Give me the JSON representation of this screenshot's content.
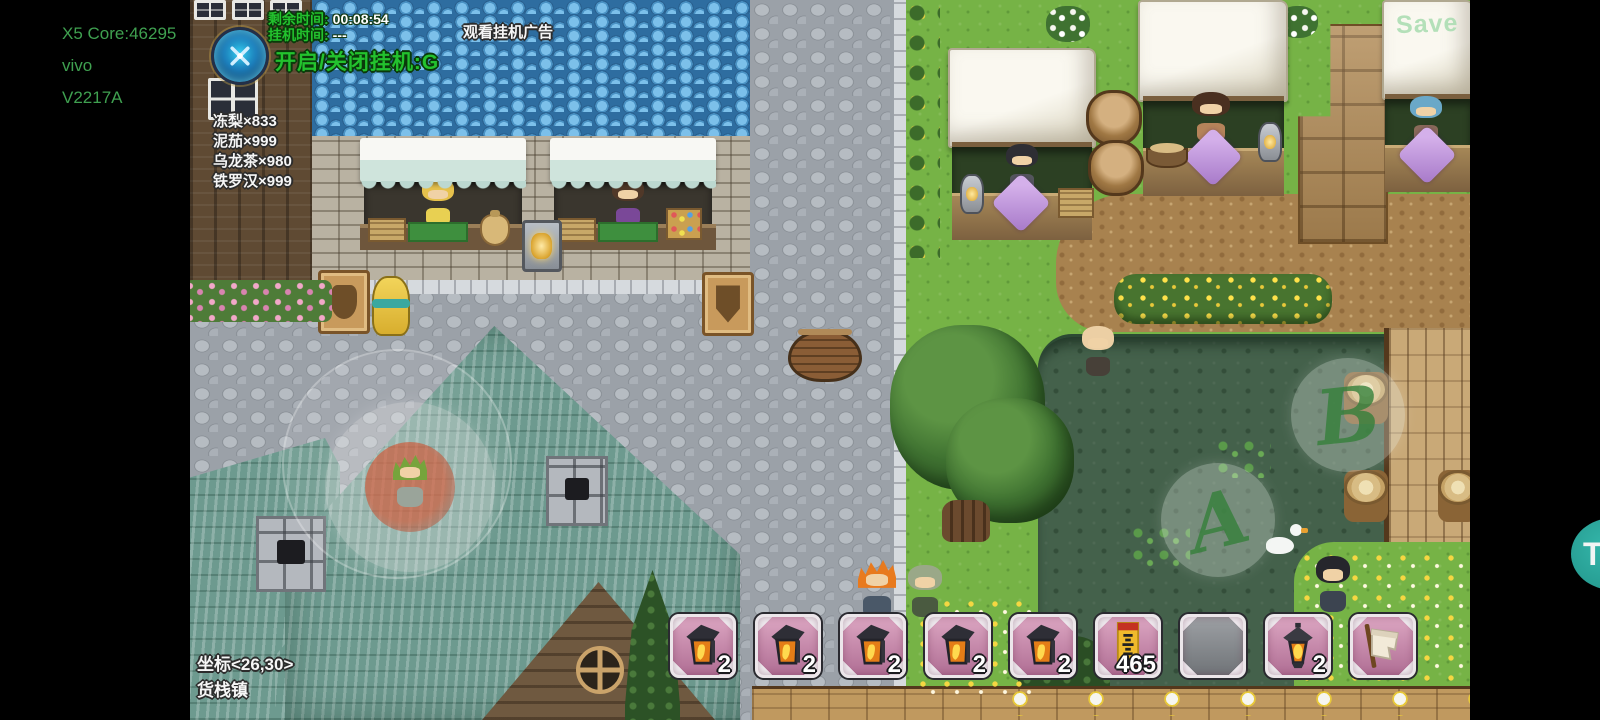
{
  "device_overlay": {
    "lines": [
      "X5 Core:46295",
      "vivo",
      "V2217A"
    ]
  },
  "hud": {
    "badge_icon": "crossed-swords-emblem",
    "remaining_time_label": "剩余时间:",
    "remaining_time_value": "00:08:54",
    "idle_time_label": "挂机时间:",
    "idle_time_value": "---",
    "toggle_idle_label": "开启/关闭挂机:G",
    "watch_ad_label": "观看挂机广告",
    "inventory": [
      "冻梨×833",
      "泥茄×999",
      "乌龙茶×980",
      "铁罗汉×999"
    ],
    "coordinates": "坐标<26,30>",
    "town_name": "货栈镇"
  },
  "hotbar": {
    "slots": [
      {
        "icon": "wall-lantern",
        "count": "2"
      },
      {
        "icon": "wall-lantern",
        "count": "2"
      },
      {
        "icon": "wall-lantern",
        "count": "2"
      },
      {
        "icon": "wall-lantern",
        "count": "2"
      },
      {
        "icon": "wall-lantern",
        "count": "2"
      },
      {
        "icon": "talisman",
        "count": "465"
      },
      {
        "icon": "empty",
        "count": ""
      },
      {
        "icon": "hanging-lantern",
        "count": "2"
      },
      {
        "icon": "scroll-item",
        "count": ""
      }
    ]
  },
  "touch_controls": {
    "joystick": "virtual-joystick",
    "button_a_label": "A",
    "button_b_label": "B"
  },
  "scene": {
    "save_sign_label": "Save"
  },
  "assist_button": {
    "label": "T"
  },
  "colors": {
    "watermark_green": "#3fa050",
    "hud_green": "#23c22e",
    "slot_pink": "#c487a8",
    "assist_teal": "#28a79c"
  }
}
